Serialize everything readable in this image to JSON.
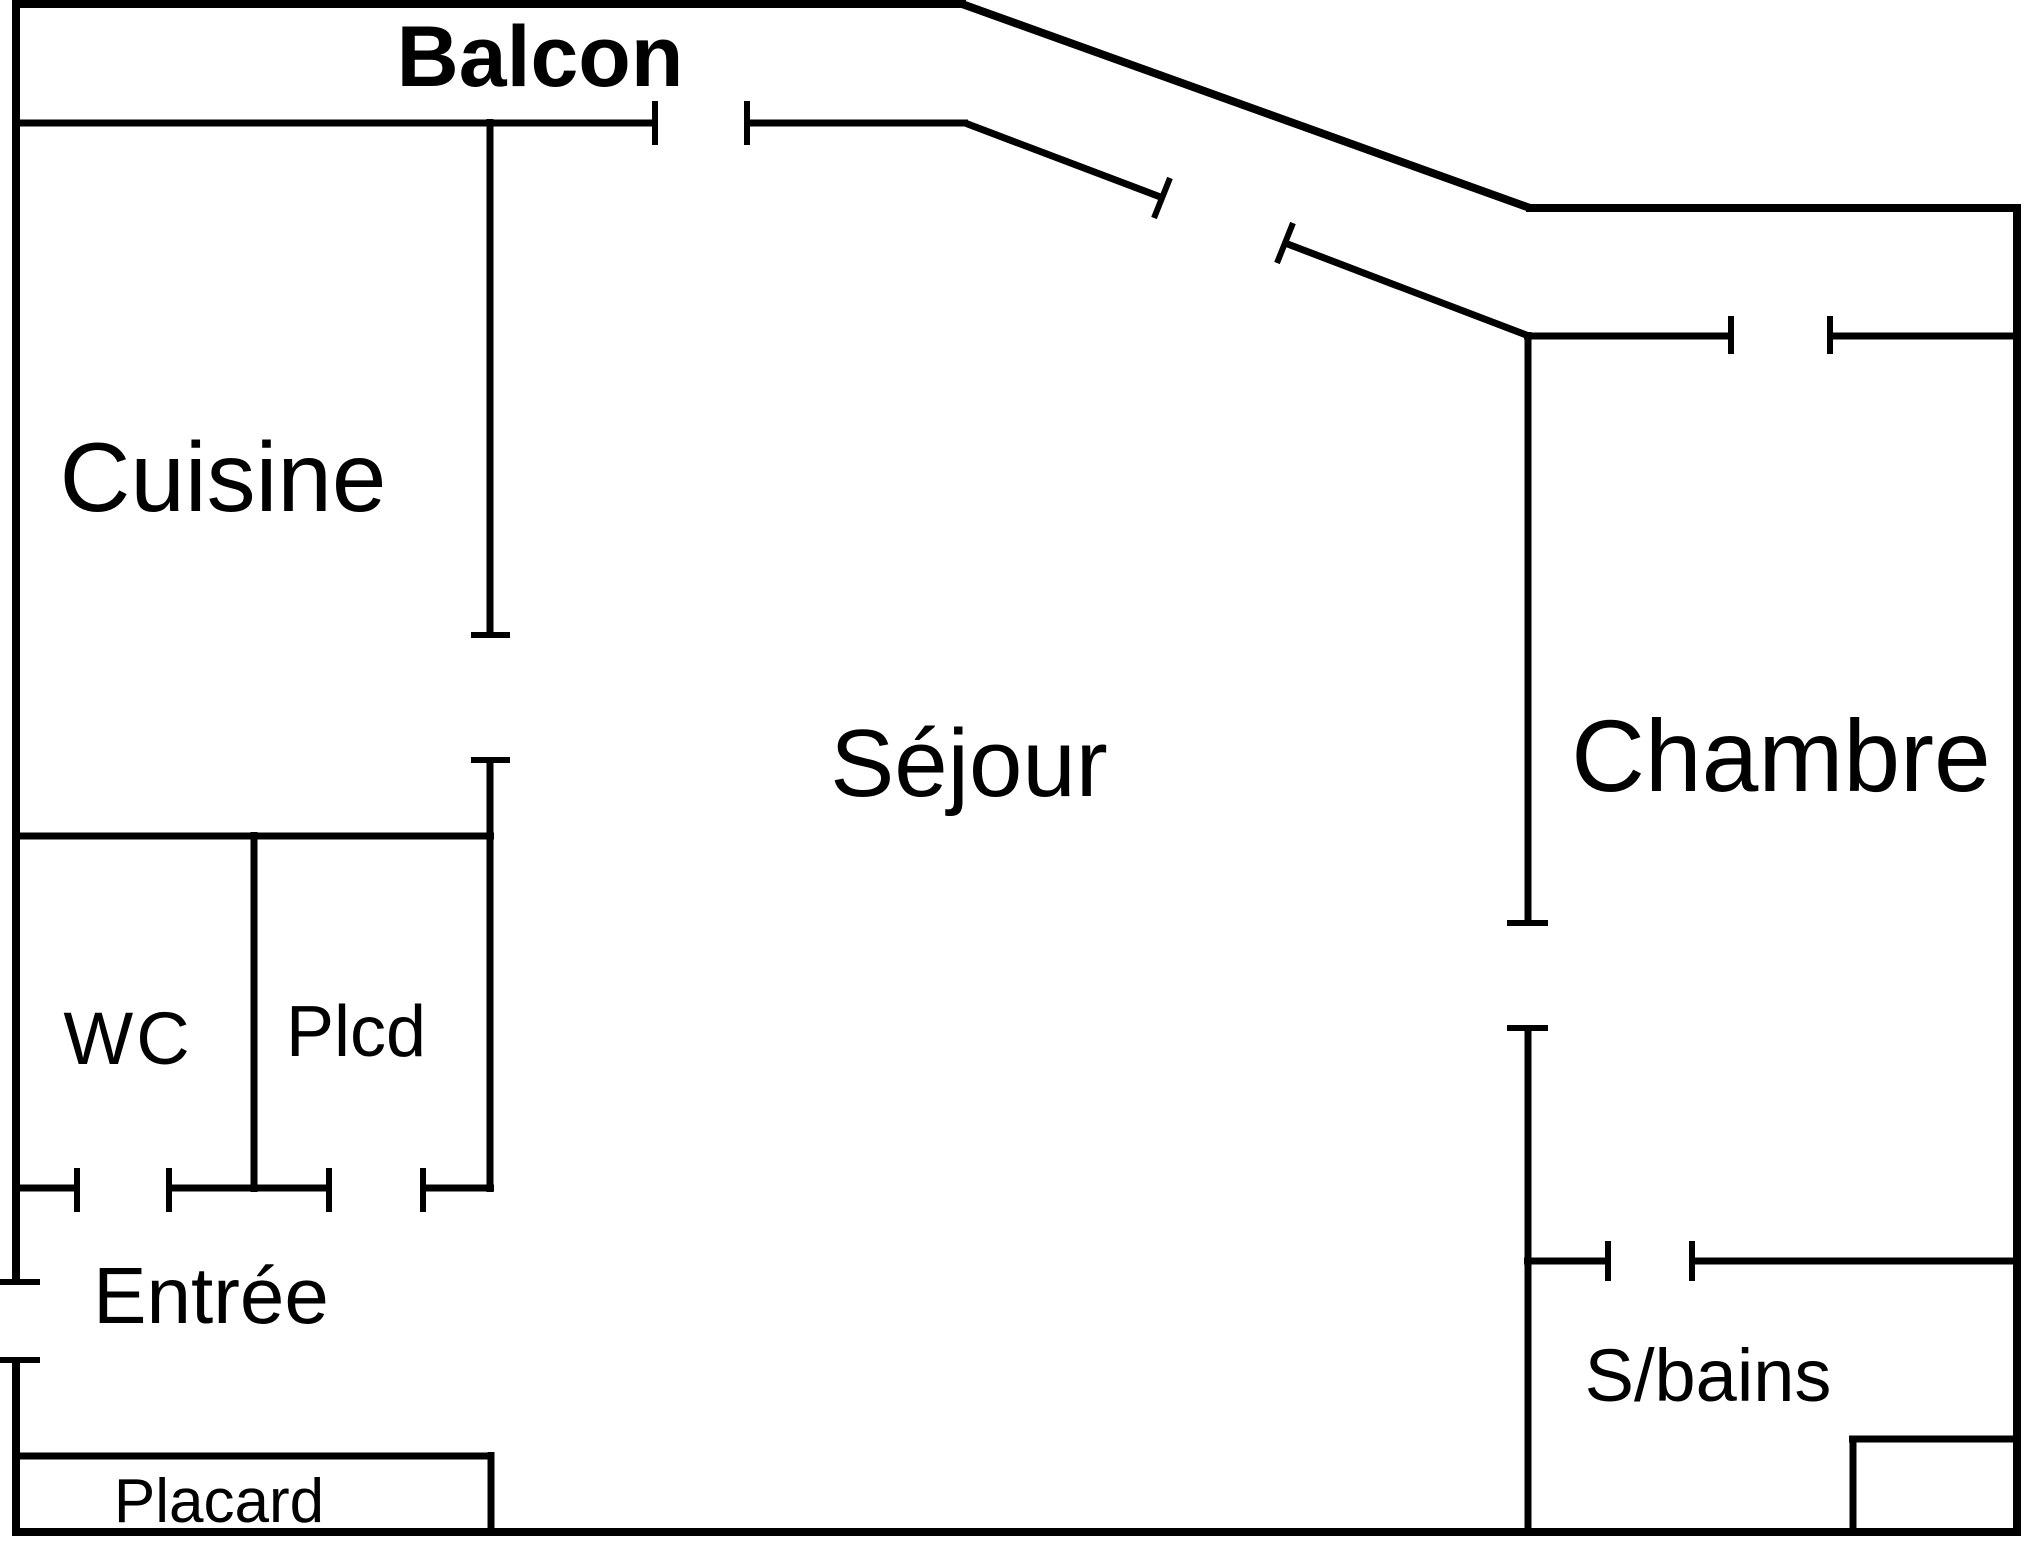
{
  "document": {
    "type": "apartment-floor-plan",
    "colors": {
      "background": "#ffffff",
      "walls": "#000000",
      "text": "#000000"
    },
    "rooms": [
      {
        "id": "balcon",
        "label": "Balcon"
      },
      {
        "id": "cuisine",
        "label": "Cuisine"
      },
      {
        "id": "sejour",
        "label": "Séjour"
      },
      {
        "id": "chambre",
        "label": "Chambre"
      },
      {
        "id": "wc",
        "label": "WC"
      },
      {
        "id": "plcd",
        "label": "Plcd"
      },
      {
        "id": "entree",
        "label": "Entrée"
      },
      {
        "id": "sbains",
        "label": "S/bains"
      },
      {
        "id": "placard",
        "label": "Placard"
      }
    ]
  }
}
